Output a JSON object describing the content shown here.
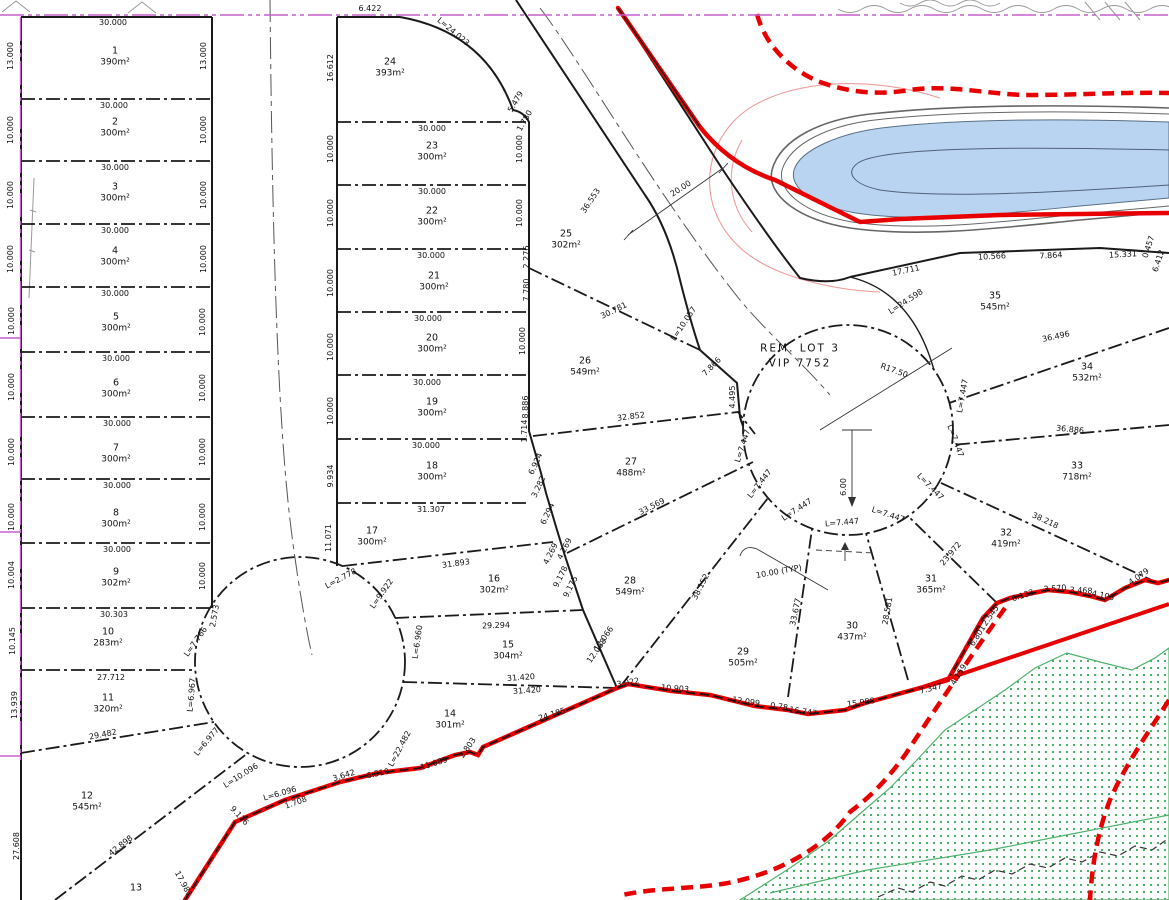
{
  "rem_lot": {
    "line1": "REM. LOT 3",
    "line2": "VIP 7752"
  },
  "colors": {
    "boundary_red": "#e80000",
    "survey_magenta": "#c65fce",
    "water_blue": "#b8d4f0",
    "vegetation_green": "#3aa858",
    "contour_pink": "#f09a9a",
    "line_black": "#1a1a1a"
  },
  "lots": [
    {
      "n": "1",
      "a": "390m²",
      "x": 115,
      "y": 52
    },
    {
      "n": "2",
      "a": "300m²",
      "x": 115,
      "y": 123
    },
    {
      "n": "3",
      "a": "300m²",
      "x": 115,
      "y": 188
    },
    {
      "n": "4",
      "a": "300m²",
      "x": 115,
      "y": 252
    },
    {
      "n": "5",
      "a": "300m²",
      "x": 116,
      "y": 318
    },
    {
      "n": "6",
      "a": "300m²",
      "x": 116,
      "y": 384
    },
    {
      "n": "7",
      "a": "300m²",
      "x": 116,
      "y": 449
    },
    {
      "n": "8",
      "a": "300m²",
      "x": 116,
      "y": 514
    },
    {
      "n": "9",
      "a": "302m²",
      "x": 116,
      "y": 573
    },
    {
      "n": "10",
      "a": "283m²",
      "x": 108,
      "y": 633
    },
    {
      "n": "11",
      "a": "320m²",
      "x": 108,
      "y": 699
    },
    {
      "n": "12",
      "a": "545m²",
      "x": 87,
      "y": 797
    },
    {
      "n": "13",
      "a": "",
      "x": 136,
      "y": 889
    },
    {
      "n": "14",
      "a": "301m²",
      "x": 450,
      "y": 715
    },
    {
      "n": "15",
      "a": "304m²",
      "x": 508,
      "y": 646
    },
    {
      "n": "16",
      "a": "302m²",
      "x": 494,
      "y": 580
    },
    {
      "n": "17",
      "a": "300m²",
      "x": 372,
      "y": 532
    },
    {
      "n": "18",
      "a": "300m²",
      "x": 432,
      "y": 467
    },
    {
      "n": "19",
      "a": "300m²",
      "x": 432,
      "y": 403
    },
    {
      "n": "20",
      "a": "300m²",
      "x": 432,
      "y": 339
    },
    {
      "n": "21",
      "a": "300m²",
      "x": 434,
      "y": 277
    },
    {
      "n": "22",
      "a": "300m²",
      "x": 432,
      "y": 212
    },
    {
      "n": "23",
      "a": "300m²",
      "x": 432,
      "y": 147
    },
    {
      "n": "24",
      "a": "393m²",
      "x": 390,
      "y": 63
    },
    {
      "n": "25",
      "a": "302m²",
      "x": 566,
      "y": 235
    },
    {
      "n": "26",
      "a": "549m²",
      "x": 585,
      "y": 362
    },
    {
      "n": "27",
      "a": "488m²",
      "x": 631,
      "y": 463
    },
    {
      "n": "28",
      "a": "549m²",
      "x": 630,
      "y": 582
    },
    {
      "n": "29",
      "a": "505m²",
      "x": 743,
      "y": 653
    },
    {
      "n": "30",
      "a": "437m²",
      "x": 852,
      "y": 627
    },
    {
      "n": "31",
      "a": "365m²",
      "x": 931,
      "y": 580
    },
    {
      "n": "32",
      "a": "419m²",
      "x": 1006,
      "y": 534
    },
    {
      "n": "33",
      "a": "718m²",
      "x": 1077,
      "y": 467
    },
    {
      "n": "34",
      "a": "532m²",
      "x": 1087,
      "y": 368
    },
    {
      "n": "35",
      "a": "545m²",
      "x": 995,
      "y": 297
    }
  ],
  "labels": [
    {
      "t": "30.000",
      "x": 113,
      "y": 23
    },
    {
      "t": "6.422",
      "x": 370,
      "y": 9
    },
    {
      "t": "L=24.023",
      "x": 453,
      "y": 32,
      "r": 40
    },
    {
      "t": "16.612",
      "x": 331,
      "y": 68,
      "r": -90
    },
    {
      "t": "5.479",
      "x": 516,
      "y": 102,
      "r": -60
    },
    {
      "t": "1.780",
      "x": 525,
      "y": 121,
      "r": -60
    },
    {
      "t": "2.276",
      "x": 527,
      "y": 257,
      "r": -90
    },
    {
      "t": "7.780",
      "x": 527,
      "y": 290,
      "r": -90
    },
    {
      "t": "20.00",
      "x": 681,
      "y": 189,
      "r": -33
    },
    {
      "t": "36.553",
      "x": 591,
      "y": 201,
      "r": -56
    },
    {
      "t": "L=10.057",
      "x": 684,
      "y": 324,
      "r": -56
    },
    {
      "t": "30.781",
      "x": 614,
      "y": 311,
      "r": -26
    },
    {
      "t": "7.866",
      "x": 712,
      "y": 367,
      "r": -45
    },
    {
      "t": "4.495",
      "x": 733,
      "y": 397,
      "r": -90
    },
    {
      "t": "R17.50",
      "x": 894,
      "y": 371,
      "r": 20
    },
    {
      "t": "L=24.598",
      "x": 906,
      "y": 302,
      "r": -33
    },
    {
      "t": "17.711",
      "x": 906,
      "y": 271,
      "r": -12
    },
    {
      "t": "10.566",
      "x": 992,
      "y": 257,
      "r": -3
    },
    {
      "t": "7.864",
      "x": 1051,
      "y": 256,
      "r": -3
    },
    {
      "t": "15.331",
      "x": 1123,
      "y": 255,
      "r": -3
    },
    {
      "t": "0.457",
      "x": 1149,
      "y": 247,
      "r": -72
    },
    {
      "t": "6.412",
      "x": 1159,
      "y": 261,
      "r": -72
    },
    {
      "t": "30.000",
      "x": 114,
      "y": 106
    },
    {
      "t": "30.000",
      "x": 115,
      "y": 168
    },
    {
      "t": "30.000",
      "x": 115,
      "y": 231
    },
    {
      "t": "30.000",
      "x": 115,
      "y": 294
    },
    {
      "t": "30.000",
      "x": 116,
      "y": 359
    },
    {
      "t": "30.000",
      "x": 117,
      "y": 424
    },
    {
      "t": "30.000",
      "x": 117,
      "y": 486
    },
    {
      "t": "30.000",
      "x": 117,
      "y": 550
    },
    {
      "t": "30.303",
      "x": 114,
      "y": 615
    },
    {
      "t": "27.712",
      "x": 111,
      "y": 678
    },
    {
      "t": "29.482",
      "x": 103,
      "y": 735,
      "r": -11
    },
    {
      "t": "42.898",
      "x": 121,
      "y": 846,
      "r": -38
    },
    {
      "t": "13.000",
      "x": 11,
      "y": 56,
      "r": -90
    },
    {
      "t": "10.000",
      "x": 11,
      "y": 130,
      "r": -90
    },
    {
      "t": "10.000",
      "x": 11,
      "y": 195,
      "r": -90
    },
    {
      "t": "10.000",
      "x": 11,
      "y": 259,
      "r": -90
    },
    {
      "t": "10.000",
      "x": 12,
      "y": 321,
      "r": -90
    },
    {
      "t": "10.000",
      "x": 12,
      "y": 387,
      "r": -90
    },
    {
      "t": "10.000",
      "x": 12,
      "y": 452,
      "r": -90
    },
    {
      "t": "10.000",
      "x": 12,
      "y": 517,
      "r": -90
    },
    {
      "t": "10.004",
      "x": 12,
      "y": 575,
      "r": -90
    },
    {
      "t": "10.145",
      "x": 13,
      "y": 641,
      "r": -90
    },
    {
      "t": "13.939",
      "x": 15,
      "y": 705,
      "r": -90
    },
    {
      "t": "27.608",
      "x": 17,
      "y": 846,
      "r": -90
    },
    {
      "t": "13.000",
      "x": 204,
      "y": 56,
      "r": -90
    },
    {
      "t": "10.000",
      "x": 204,
      "y": 130,
      "r": -90
    },
    {
      "t": "10.000",
      "x": 204,
      "y": 195,
      "r": -90
    },
    {
      "t": "10.000",
      "x": 204,
      "y": 259,
      "r": -90
    },
    {
      "t": "10.000",
      "x": 203,
      "y": 322,
      "r": -90
    },
    {
      "t": "10.000",
      "x": 203,
      "y": 388,
      "r": -90
    },
    {
      "t": "10.000",
      "x": 203,
      "y": 452,
      "r": -90
    },
    {
      "t": "10.000",
      "x": 203,
      "y": 517,
      "r": -90
    },
    {
      "t": "10.000",
      "x": 203,
      "y": 576,
      "r": -90
    },
    {
      "t": "30.000",
      "x": 432,
      "y": 129
    },
    {
      "t": "30.000",
      "x": 432,
      "y": 192
    },
    {
      "t": "30.000",
      "x": 431,
      "y": 256
    },
    {
      "t": "30.000",
      "x": 428,
      "y": 319
    },
    {
      "t": "30.000",
      "x": 427,
      "y": 383
    },
    {
      "t": "30.000",
      "x": 426,
      "y": 446
    },
    {
      "t": "31.307",
      "x": 431,
      "y": 510
    },
    {
      "t": "31.893",
      "x": 456,
      "y": 564,
      "r": -8
    },
    {
      "t": "29.294",
      "x": 496,
      "y": 626,
      "r": -2
    },
    {
      "t": "31.420",
      "x": 521,
      "y": 678,
      "r": -4
    },
    {
      "t": "31.420",
      "x": 527,
      "y": 691,
      "r": -4
    },
    {
      "t": "10.000",
      "x": 331,
      "y": 149,
      "r": -90
    },
    {
      "t": "10.000",
      "x": 331,
      "y": 213,
      "r": -90
    },
    {
      "t": "10.000",
      "x": 331,
      "y": 283,
      "r": -90
    },
    {
      "t": "10.000",
      "x": 331,
      "y": 347,
      "r": -90
    },
    {
      "t": "10.000",
      "x": 331,
      "y": 411,
      "r": -90
    },
    {
      "t": "9.934",
      "x": 331,
      "y": 476,
      "r": -90
    },
    {
      "t": "11.071",
      "x": 329,
      "y": 538,
      "r": -90
    },
    {
      "t": "10.000",
      "x": 520,
      "y": 149,
      "r": -90
    },
    {
      "t": "10.000",
      "x": 520,
      "y": 213,
      "r": -90
    },
    {
      "t": "10.000",
      "x": 523,
      "y": 341,
      "r": -90
    },
    {
      "t": "8.886",
      "x": 526,
      "y": 407,
      "r": -90
    },
    {
      "t": "1.714",
      "x": 525,
      "y": 431,
      "r": -90
    },
    {
      "t": "6.924",
      "x": 536,
      "y": 464,
      "r": -65
    },
    {
      "t": "3.282",
      "x": 539,
      "y": 487,
      "r": -65
    },
    {
      "t": "6.294",
      "x": 548,
      "y": 514,
      "r": -65
    },
    {
      "t": "4.269",
      "x": 565,
      "y": 549,
      "r": -63
    },
    {
      "t": "4.269",
      "x": 551,
      "y": 554,
      "r": -63
    },
    {
      "t": "9.178",
      "x": 561,
      "y": 577,
      "r": -63
    },
    {
      "t": "9.175",
      "x": 571,
      "y": 587,
      "r": -63
    },
    {
      "t": "12.066",
      "x": 604,
      "y": 639,
      "r": -55
    },
    {
      "t": "12.068",
      "x": 597,
      "y": 651,
      "r": -55
    },
    {
      "t": "2.573",
      "x": 215,
      "y": 616,
      "r": -80
    },
    {
      "t": "L=7.766",
      "x": 196,
      "y": 642,
      "r": -55
    },
    {
      "t": "L=6.967",
      "x": 192,
      "y": 695,
      "r": -85
    },
    {
      "t": "L=6.977",
      "x": 207,
      "y": 742,
      "r": -50
    },
    {
      "t": "L=10.096",
      "x": 241,
      "y": 776,
      "r": -32
    },
    {
      "t": "L=6.096",
      "x": 280,
      "y": 794,
      "r": -16
    },
    {
      "t": "1.708",
      "x": 296,
      "y": 803,
      "r": -20
    },
    {
      "t": "L=2.778",
      "x": 341,
      "y": 579,
      "r": -28
    },
    {
      "t": "L=9.922",
      "x": 382,
      "y": 594,
      "r": -55
    },
    {
      "t": "L=6.960",
      "x": 418,
      "y": 642,
      "r": -82
    },
    {
      "t": "L=22.482",
      "x": 400,
      "y": 749,
      "r": -62
    },
    {
      "t": "17.981",
      "x": 183,
      "y": 884,
      "r": 62
    },
    {
      "t": "9.116",
      "x": 239,
      "y": 816,
      "r": 47
    },
    {
      "t": "3.642",
      "x": 344,
      "y": 776,
      "r": -17
    },
    {
      "t": "6.310",
      "x": 378,
      "y": 774,
      "r": -12
    },
    {
      "t": "11.089",
      "x": 434,
      "y": 764,
      "r": -17
    },
    {
      "t": "2.803",
      "x": 468,
      "y": 748,
      "r": -55
    },
    {
      "t": "24.185",
      "x": 552,
      "y": 715,
      "r": -17
    },
    {
      "t": "3.022",
      "x": 628,
      "y": 683,
      "r": -10
    },
    {
      "t": "10.903",
      "x": 675,
      "y": 689,
      "r": 4
    },
    {
      "t": "12.099",
      "x": 746,
      "y": 702,
      "r": 8
    },
    {
      "t": "0.78",
      "x": 779,
      "y": 707,
      "r": 8
    },
    {
      "t": "16.747",
      "x": 803,
      "y": 712,
      "r": 8
    },
    {
      "t": "15.988",
      "x": 861,
      "y": 703,
      "r": -8
    },
    {
      "t": "7.347",
      "x": 931,
      "y": 689,
      "r": -14
    },
    {
      "t": "4.159",
      "x": 959,
      "y": 675,
      "r": -58
    },
    {
      "t": "6.801",
      "x": 978,
      "y": 636,
      "r": -58
    },
    {
      "t": "2.545",
      "x": 991,
      "y": 616,
      "r": -55
    },
    {
      "t": "6.133",
      "x": 1023,
      "y": 596,
      "r": -18
    },
    {
      "t": "3.570",
      "x": 1055,
      "y": 589,
      "r": -4
    },
    {
      "t": "3.468",
      "x": 1081,
      "y": 591,
      "r": 3
    },
    {
      "t": "4.103",
      "x": 1103,
      "y": 596,
      "r": 12
    },
    {
      "t": "4.079",
      "x": 1139,
      "y": 577,
      "r": -35
    },
    {
      "t": "32.852",
      "x": 631,
      "y": 417,
      "r": -7
    },
    {
      "t": "33.569",
      "x": 652,
      "y": 507,
      "r": -27
    },
    {
      "t": "38.152",
      "x": 701,
      "y": 587,
      "r": -63
    },
    {
      "t": "33.677",
      "x": 796,
      "y": 612,
      "r": -78
    },
    {
      "t": "28.581",
      "x": 888,
      "y": 611,
      "r": -80
    },
    {
      "t": "23.972",
      "x": 951,
      "y": 554,
      "r": -50
    },
    {
      "t": "38.218",
      "x": 1045,
      "y": 521,
      "r": 25
    },
    {
      "t": "36.886",
      "x": 1070,
      "y": 430,
      "r": 6
    },
    {
      "t": "36.496",
      "x": 1056,
      "y": 337,
      "r": -12
    },
    {
      "t": "10.00 (TYP)",
      "x": 779,
      "y": 572,
      "r": -10
    },
    {
      "t": "6.00",
      "x": 844,
      "y": 487,
      "r": -90
    },
    {
      "t": "L=7.447",
      "x": 743,
      "y": 446,
      "r": -72
    },
    {
      "t": "L=7.447",
      "x": 760,
      "y": 484,
      "r": -52
    },
    {
      "t": "L=7.447",
      "x": 797,
      "y": 510,
      "r": -33
    },
    {
      "t": "L=7.447",
      "x": 842,
      "y": 523,
      "r": -5
    },
    {
      "t": "L=7.447",
      "x": 888,
      "y": 515,
      "r": 18
    },
    {
      "t": "L=7.447",
      "x": 930,
      "y": 487,
      "r": 45
    },
    {
      "t": "L=7.447",
      "x": 955,
      "y": 441,
      "r": 70
    },
    {
      "t": "L=7.447",
      "x": 963,
      "y": 396,
      "r": -80
    }
  ]
}
